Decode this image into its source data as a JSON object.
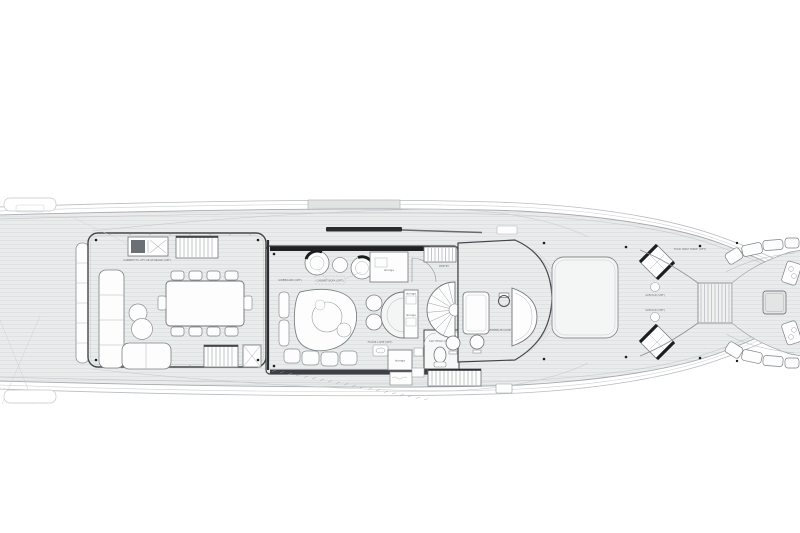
{
  "meta": {
    "title": "Yacht Upper Deck General Arrangement Plan"
  },
  "colors": {
    "paper": "#ffffff",
    "deck_fill": "#eaecec",
    "plank_line": "#d9dcdc",
    "furniture_outline": "#8a9094",
    "wall": "#3d4246",
    "accent_black": "#1b1d1f"
  },
  "labels": {
    "cabinet_tv": "CABINET/TV LIFT OR STORAGE (OPT)",
    "sideboard": "SIDEBOARD (OPT)",
    "cabinet_sofa": "CABINET/SOFA (OPT)",
    "storage": "storage",
    "pantry": "PANTRY",
    "floor_lamp": "FLOOR LAMP (OPT)",
    "day_head": "DAY HEAD (OPT)",
    "wheelhouse": "WHEELHOUSE",
    "sun_pad": "SUN PAD (OPT)",
    "fold_table": "FOLD AWAY TABLE (OPT)"
  }
}
